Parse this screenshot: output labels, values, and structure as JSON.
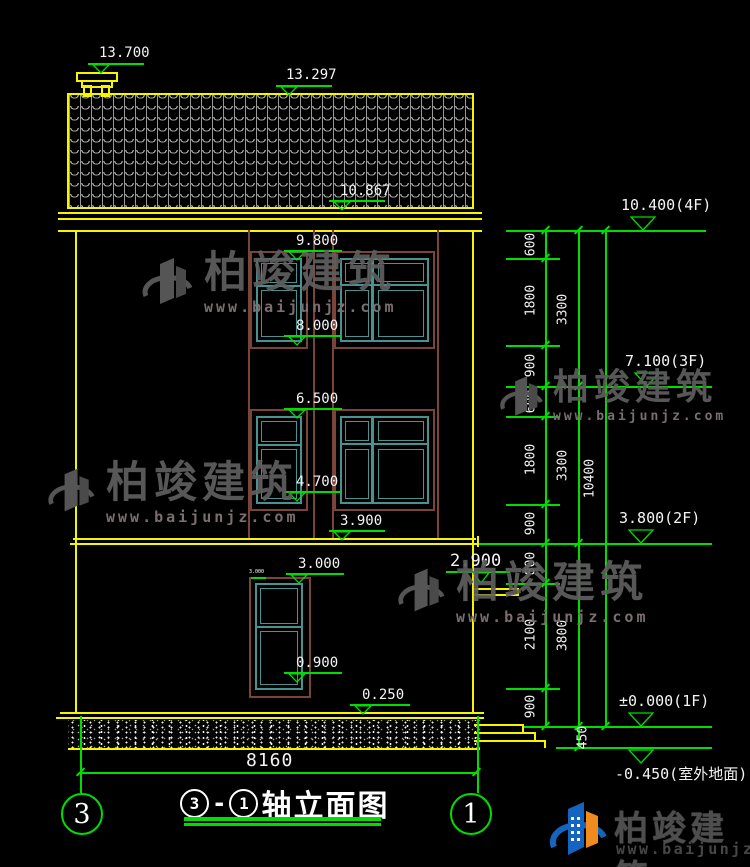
{
  "drawing": {
    "title": {
      "axis_start": "3",
      "separator": "-",
      "axis_end": "1",
      "name": "轴立面图"
    },
    "axis_bubbles": {
      "left": "3",
      "right": "1"
    },
    "levels": {
      "chimney": "13.700",
      "ridge": "13.297",
      "eave": "10.867",
      "f4": "10.400(4F)",
      "f3": "7.100(3F)",
      "f2": "3.800(2F)",
      "f1": "±0.000(1F)",
      "ground": "-0.450(室外地面)",
      "w3_top": "9.800",
      "w3_sill": "8.000",
      "w2_top": "6.500",
      "w2_sill": "4.700",
      "slab2": "3.900",
      "canopy": "2.900",
      "w1_top": "3.000",
      "w1_sill": "0.900",
      "plinth": "0.250",
      "w1_tag": "3.000"
    },
    "dimensions": {
      "right_col1": [
        "600",
        "1800",
        "900",
        "600",
        "1800",
        "900",
        "800",
        "2100",
        "900"
      ],
      "right_col2": [
        "3300",
        "3300",
        "3800"
      ],
      "right_col3": [
        "10400"
      ],
      "below_zero": "450",
      "overall_width": "8160"
    },
    "watermark": {
      "brand": "柏竣建筑",
      "url": "www.baijunjz.com"
    },
    "logo": {
      "brand": "柏竣建筑",
      "url": "www.baijunjz.com"
    },
    "colors": {
      "line_green": "#00dd00",
      "line_yellow": "#f5f500",
      "window_teal": "#4a9191",
      "frame_brown": "#7b4438"
    }
  }
}
